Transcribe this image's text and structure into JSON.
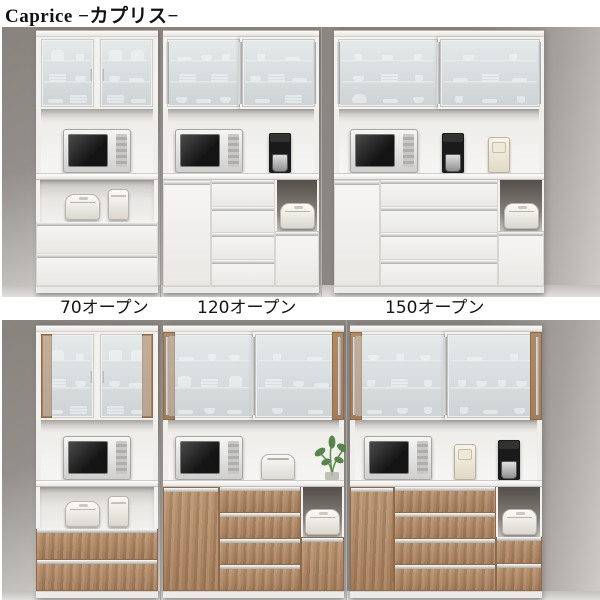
{
  "title": "Caprice −カプリス−",
  "size_labels": [
    "70オープン",
    "120オープン",
    "150オープン"
  ],
  "colors": {
    "wood": "#b08a65",
    "cabinet_white": "#f3f2f0",
    "wall_gray": "#8d8883",
    "floor_gray": "#d6d4d1",
    "glass_frost": "#dfe4e5"
  },
  "appliances": [
    "microwave",
    "coffee-maker",
    "rice-cooker",
    "thermo-pot",
    "toaster",
    "houseplant",
    "food-processor"
  ]
}
